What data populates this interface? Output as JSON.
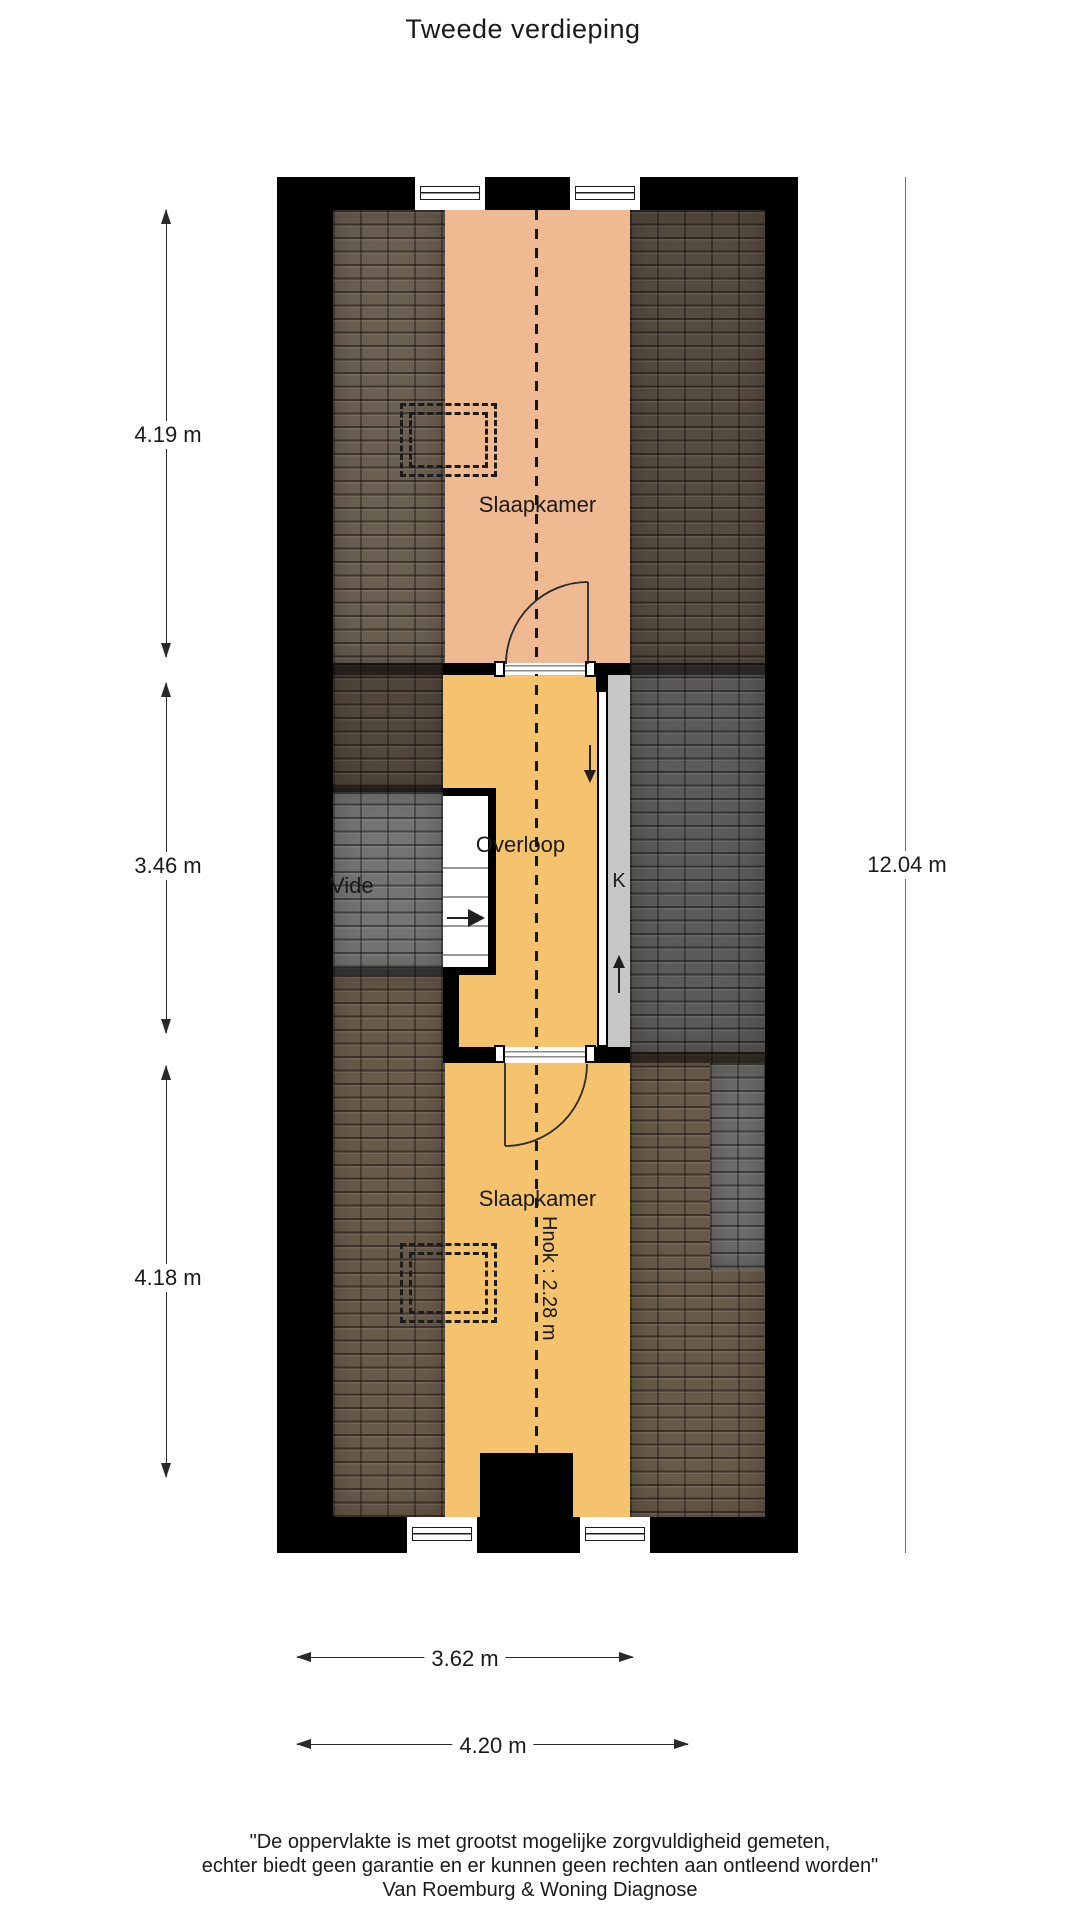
{
  "title": "Tweede verdieping",
  "plan": {
    "rooms": {
      "bedroom_top": "Slaapkamer",
      "landing": "Overloop",
      "void_area": "Vide",
      "closet": "K",
      "bedroom_bottom": "Slaapkamer",
      "headroom_note": "Hnok : 2.28 m"
    },
    "dimensions": {
      "left": [
        "4.19 m",
        "3.46 m",
        "4.18 m"
      ],
      "right": "12.04 m",
      "bottom": [
        "3.62 m",
        "4.20 m"
      ]
    }
  },
  "footer": {
    "line1": "\"De oppervlakte is met grootst mogelijke zorgvuldigheid gemeten,",
    "line2": "echter biedt geen garantie en er kunnen geen rechten aan ontleend worden\"",
    "line3": "Van Roemburg & Woning Diagnose"
  },
  "colors": {
    "wall": "#000000",
    "bedroom_top_fill": "#efb991",
    "landing_fill": "#f5c36e",
    "closet_strip_fill": "#c7c7c7",
    "roof_top_left": "#6b5f51",
    "roof_top_right": "#564b3f",
    "roof_mid_left": "#52473b",
    "roof_void_gray": "#757473",
    "roof_mid_right": "#5c5b59",
    "roof_bottom_left": "#695b4a",
    "roof_bottom_right": "#685a49",
    "roof_bottom_right_gray": "#6f6e6c"
  }
}
